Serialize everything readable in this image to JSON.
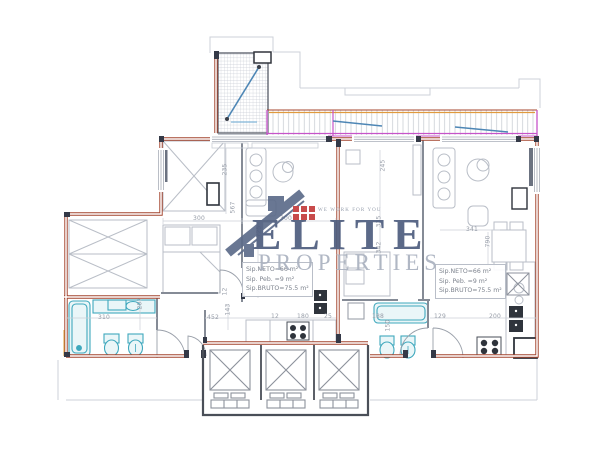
{
  "watermark": {
    "brand": "ELITE",
    "brand_sub": "PROPERTIES",
    "tagline": "WE WORK FOR YOU",
    "colors": {
      "brand": "#4e5d7e",
      "sub": "#aab1bf",
      "house": "#5d6c8a",
      "accent_red": "#c43c3c"
    }
  },
  "units": {
    "left": {
      "area_lines": [
        "Sip.NETO=66 m²",
        "Sip. Peb. =9 m²",
        "Sip.BRUTO=75.5 m²"
      ]
    },
    "right": {
      "area_lines": [
        "Sip.NETO=66 m²",
        "Sip. Peb. =9 m²",
        "Sip.BRUTO=75.5 m²"
      ]
    }
  },
  "plan_colors": {
    "wall_red": "#a4452e",
    "balcony_magenta": "#c653c9",
    "balcony_orange": "#e09a3e",
    "drain_blue": "#4d86b5",
    "fixture_cyan": "#3fa8bd",
    "line_gray": "#b9bec7"
  },
  "dimensions": [
    {
      "text": "300",
      "x": 193,
      "y": 215,
      "rot": 0
    },
    {
      "text": "300",
      "x": 280,
      "y": 215,
      "rot": 0
    },
    {
      "text": "235",
      "x": 219,
      "y": 166,
      "rot": 90
    },
    {
      "text": "567",
      "x": 227,
      "y": 204,
      "rot": 90
    },
    {
      "text": "725",
      "x": 253,
      "y": 228,
      "rot": 90
    },
    {
      "text": "12",
      "x": 221,
      "y": 288,
      "rot": 90
    },
    {
      "text": "310",
      "x": 98,
      "y": 314,
      "rot": 0
    },
    {
      "text": "207",
      "x": 134,
      "y": 300,
      "rot": 90
    },
    {
      "text": "452",
      "x": 207,
      "y": 314,
      "rot": 0
    },
    {
      "text": "143",
      "x": 222,
      "y": 306,
      "rot": 90
    },
    {
      "text": "12",
      "x": 271,
      "y": 313,
      "rot": 0
    },
    {
      "text": "180",
      "x": 297,
      "y": 313,
      "rot": 0
    },
    {
      "text": "25",
      "x": 324,
      "y": 313,
      "rot": 0
    },
    {
      "text": "245",
      "x": 377,
      "y": 162,
      "rot": 90
    },
    {
      "text": "335",
      "x": 373,
      "y": 218,
      "rot": 90
    },
    {
      "text": "342",
      "x": 373,
      "y": 244,
      "rot": 90
    },
    {
      "text": "341",
      "x": 466,
      "y": 226,
      "rot": 0
    },
    {
      "text": "790",
      "x": 482,
      "y": 238,
      "rot": 90
    },
    {
      "text": "188",
      "x": 372,
      "y": 313,
      "rot": 0
    },
    {
      "text": "150",
      "x": 382,
      "y": 322,
      "rot": 90
    },
    {
      "text": "129",
      "x": 434,
      "y": 313,
      "rot": 0
    },
    {
      "text": "200",
      "x": 489,
      "y": 313,
      "rot": 0
    }
  ]
}
